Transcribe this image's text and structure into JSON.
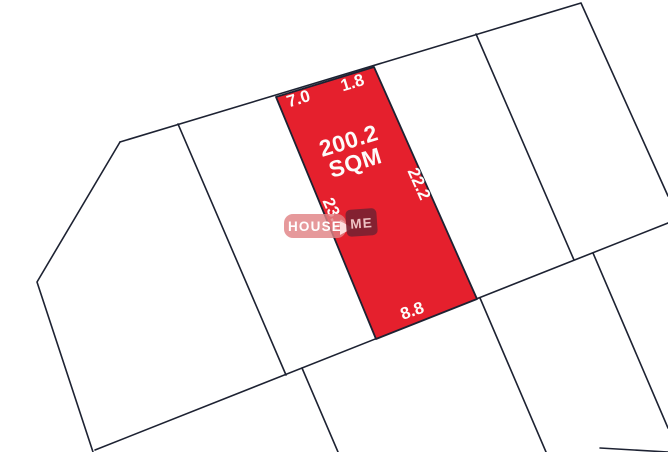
{
  "highlighted_plot": {
    "area_value": "200.2",
    "area_unit": "SQM",
    "dimensions": {
      "top_left_segment": "7.0",
      "top_right_segment": "1.8",
      "right_side": "22.2",
      "left_side": "23.1",
      "bottom_side": "8.8"
    }
  },
  "watermark": {
    "brand_left": "HOUSE",
    "brand_right": "ME"
  },
  "colors": {
    "plot_fill": "#e5202d",
    "boundary_line": "#1d2232",
    "label_text": "#fdfcfa",
    "watermark_left_bg": "#e18285",
    "watermark_right_bg": "#7b2232",
    "watermark_right_text": "#eec2c4"
  }
}
